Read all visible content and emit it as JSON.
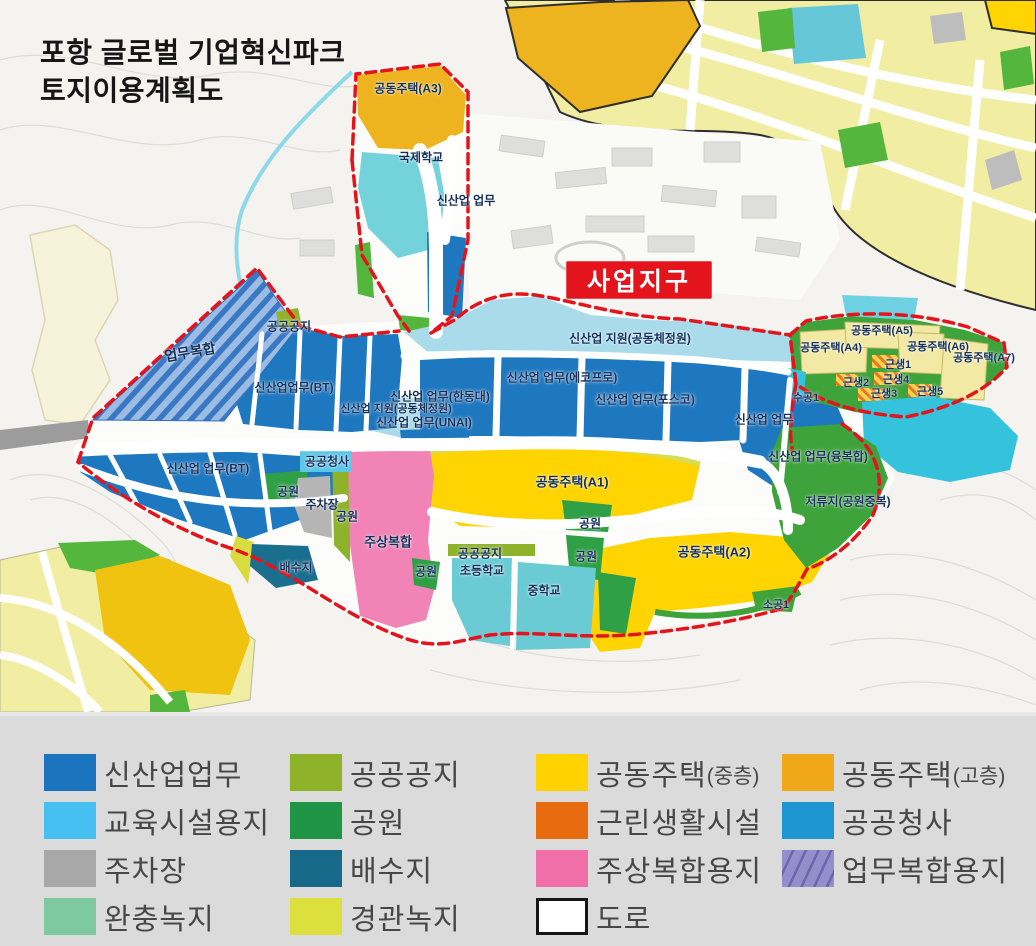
{
  "title": {
    "line1": "포항 글로벌 기업혁신파크",
    "line2": "토지이용계획도"
  },
  "badge": {
    "label": "사업지구",
    "bg": "#E3141C",
    "text_color": "#FFFFFF"
  },
  "palette": {
    "boundary_red": "#E3141C",
    "new_industry_blue": "#1E78C0",
    "industry_support_lightblue": "#A9DBEA",
    "education_cyan": "#45C0F0",
    "school_cyan": "#6BCBD4",
    "apartment_mid_yellow": "#FFD200",
    "apartment_high_orange": "#F0A818",
    "pale_housing_yellow": "#F2E9A4",
    "neighborhood_orange": "#E86C0F",
    "civic_blue": "#1D96D2",
    "parking_gray": "#A8A8A8",
    "drainage_teal": "#17698A",
    "mixeduse_pink": "#F06FA9",
    "business_mix_purple": "#8F8CC8",
    "buffer_green": "#7FC9A1",
    "landscape_yellowgreen": "#DDE03C",
    "public_open_olive": "#8EB32B",
    "park_green": "#1E9444",
    "water_cyan": "#35C2DC",
    "road_white": "#FFFFFF"
  },
  "map": {
    "labels": [
      {
        "text": "공동주택(A3)",
        "x": 408,
        "y": 88
      },
      {
        "text": "국제학교",
        "x": 421,
        "y": 157
      },
      {
        "text": "신산업 업무",
        "x": 466,
        "y": 200
      },
      {
        "text": "공공공지",
        "x": 289,
        "y": 326
      },
      {
        "text": "업무복합",
        "x": 190,
        "y": 352,
        "rot": -10,
        "size": 14
      },
      {
        "text": "신산업업무(BT)",
        "x": 294,
        "y": 387
      },
      {
        "text": "신산업 지원(공동체정원)",
        "x": 630,
        "y": 338
      },
      {
        "text": "공동주택(A4)",
        "x": 831,
        "y": 347,
        "size": 11
      },
      {
        "text": "공동주택(A5)",
        "x": 882,
        "y": 330,
        "size": 11
      },
      {
        "text": "공동주택(A6)",
        "x": 938,
        "y": 346,
        "size": 11
      },
      {
        "text": "공동주택(A7)",
        "x": 984,
        "y": 357,
        "size": 11
      },
      {
        "text": "신산업 업무(에코프로)",
        "x": 562,
        "y": 377
      },
      {
        "text": "신산업 업무(한동대)",
        "x": 440,
        "y": 396
      },
      {
        "text": "신산업 지원(공동체정원)",
        "x": 396,
        "y": 408,
        "size": 11
      },
      {
        "text": "근생1",
        "x": 898,
        "y": 364,
        "size": 11
      },
      {
        "text": "근생2",
        "x": 856,
        "y": 382,
        "size": 11
      },
      {
        "text": "근생4",
        "x": 896,
        "y": 379,
        "size": 11
      },
      {
        "text": "근생3",
        "x": 884,
        "y": 393,
        "size": 11
      },
      {
        "text": "근생5",
        "x": 930,
        "y": 391,
        "size": 11
      },
      {
        "text": "신산업 업무(포스코)",
        "x": 645,
        "y": 399
      },
      {
        "text": "수공1",
        "x": 806,
        "y": 397,
        "size": 11
      },
      {
        "text": "신산업 업무(UNAI)",
        "x": 424,
        "y": 422
      },
      {
        "text": "신산업 업무",
        "x": 764,
        "y": 419
      },
      {
        "text": "신산업 업무(BT)",
        "x": 208,
        "y": 468
      },
      {
        "text": "공공청사",
        "x": 327,
        "y": 461
      },
      {
        "text": "신산업 업무(융복합)",
        "x": 818,
        "y": 456
      },
      {
        "text": "공동주택(A1)",
        "x": 572,
        "y": 481,
        "size": 13
      },
      {
        "text": "공원",
        "x": 288,
        "y": 491
      },
      {
        "text": "주차장",
        "x": 322,
        "y": 504
      },
      {
        "text": "공원",
        "x": 347,
        "y": 516
      },
      {
        "text": "저류지(공원중복)",
        "x": 848,
        "y": 501
      },
      {
        "text": "공원",
        "x": 590,
        "y": 523
      },
      {
        "text": "주상복합",
        "x": 388,
        "y": 541,
        "size": 13
      },
      {
        "text": "공동주택(A2)",
        "x": 714,
        "y": 551,
        "size": 13
      },
      {
        "text": "배수지",
        "x": 296,
        "y": 567
      },
      {
        "text": "공공공지",
        "x": 480,
        "y": 553
      },
      {
        "text": "공원",
        "x": 586,
        "y": 556
      },
      {
        "text": "공원",
        "x": 426,
        "y": 571
      },
      {
        "text": "초등학교",
        "x": 482,
        "y": 570
      },
      {
        "text": "중학교",
        "x": 544,
        "y": 590
      },
      {
        "text": "소공1",
        "x": 776,
        "y": 604,
        "size": 11
      }
    ]
  },
  "legend": {
    "columns": [
      [
        {
          "key": "new-industry",
          "label": "신산업업무",
          "color": "#1B75BE"
        },
        {
          "key": "education",
          "label": "교육시설용지",
          "color": "#45C0F0"
        },
        {
          "key": "parking",
          "label": "주차장",
          "color": "#A8A8A8"
        },
        {
          "key": "buffer-green",
          "label": "완충녹지",
          "color": "#7FC9A1"
        }
      ],
      [
        {
          "key": "public-open",
          "label": "공공공지",
          "color": "#8EB32B"
        },
        {
          "key": "park",
          "label": "공원",
          "color": "#1E9444"
        },
        {
          "key": "drainage",
          "label": "배수지",
          "color": "#17698A"
        },
        {
          "key": "landscape-green",
          "label": "경관녹지",
          "color": "#DDE03C"
        }
      ],
      [
        {
          "key": "apartment-mid",
          "label": "공동주택",
          "suffix": "(중층)",
          "color": "#FFD200"
        },
        {
          "key": "neighborhood",
          "label": "근린생활시설",
          "color": "#E86C0F"
        },
        {
          "key": "mixed-residential",
          "label": "주상복합용지",
          "color": "#F06FA9"
        },
        {
          "key": "road",
          "label": "도로",
          "color": "#FFFFFF",
          "style": "road"
        }
      ],
      [
        {
          "key": "apartment-high",
          "label": "공동주택",
          "suffix": "(고층)",
          "color": "#F0A818"
        },
        {
          "key": "civic",
          "label": "공공청사",
          "color": "#1D96D2"
        },
        {
          "key": "business-mix",
          "label": "업무복합용지",
          "color": "#8F8CC8",
          "style": "hatch"
        }
      ]
    ]
  }
}
